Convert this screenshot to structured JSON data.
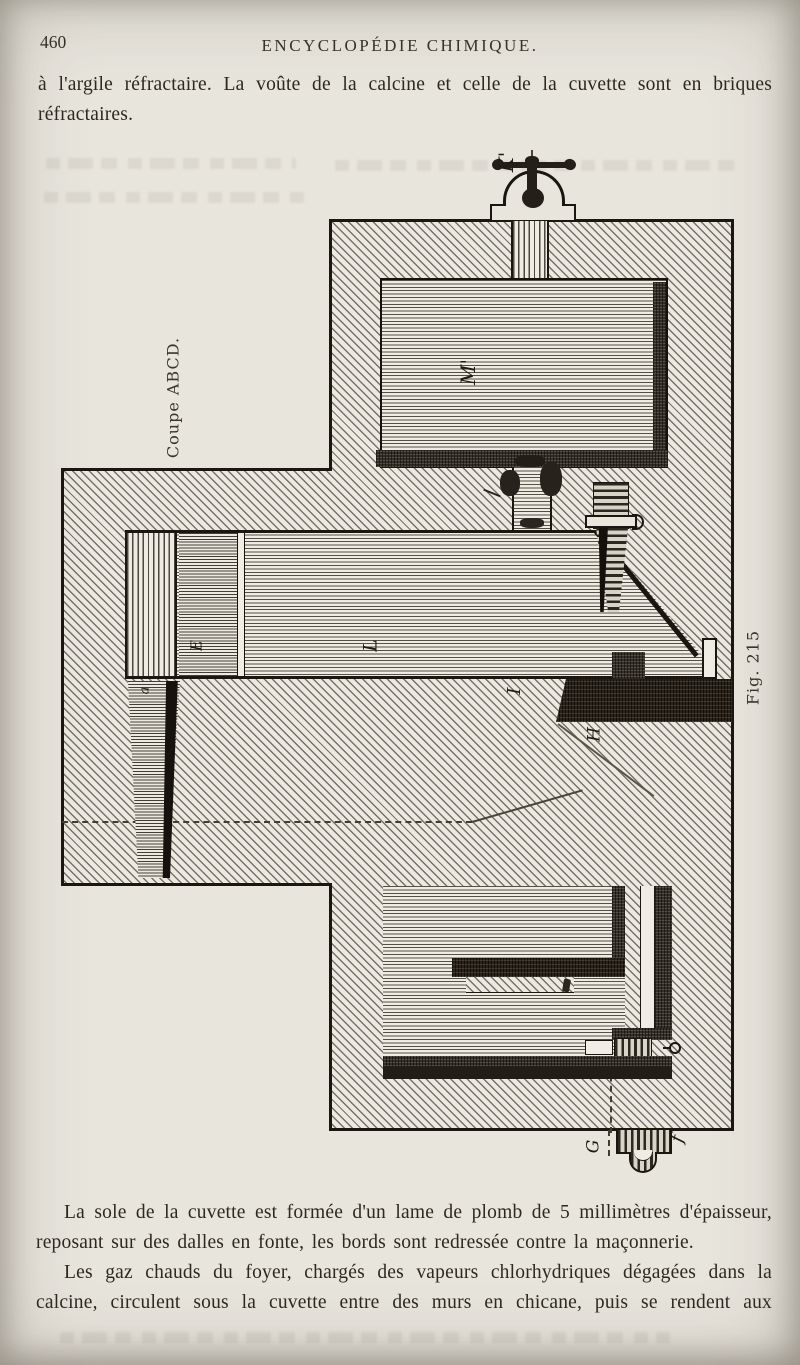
{
  "page": {
    "number": "460",
    "header": "ENCYCLOPÉDIE CHIMIQUE.",
    "top_lines": [
      "à l'argile réfractaire. La voûte de la calcine et celle de la cuvette sont en briques",
      "réfractaires."
    ],
    "para1_lines": [
      "La sole de la cuvette est formée d'un lame de plomb de 5 millimètres d'épaisseur,",
      "reposant sur des dalles en fonte, les bords sont redressée contre la maçonnerie."
    ],
    "para2_lines": [
      "Les gaz chauds du foyer, chargés des vapeurs chlorhydriques dégagées dans la",
      "calcine, circulent sous la cuvette entre des murs en chicane, puis se rendent aux"
    ]
  },
  "figure": {
    "caption": "Fig. 215",
    "section_label": "Coupe ABCD.",
    "labels": {
      "valve": "K'",
      "upper_chamber": "M'",
      "long_chamber": "L",
      "pier_i": "I",
      "lintel_h": "H",
      "wall_e": "E",
      "flue_a": "a",
      "outlet_g": "G",
      "outlet_f": "f"
    }
  }
}
